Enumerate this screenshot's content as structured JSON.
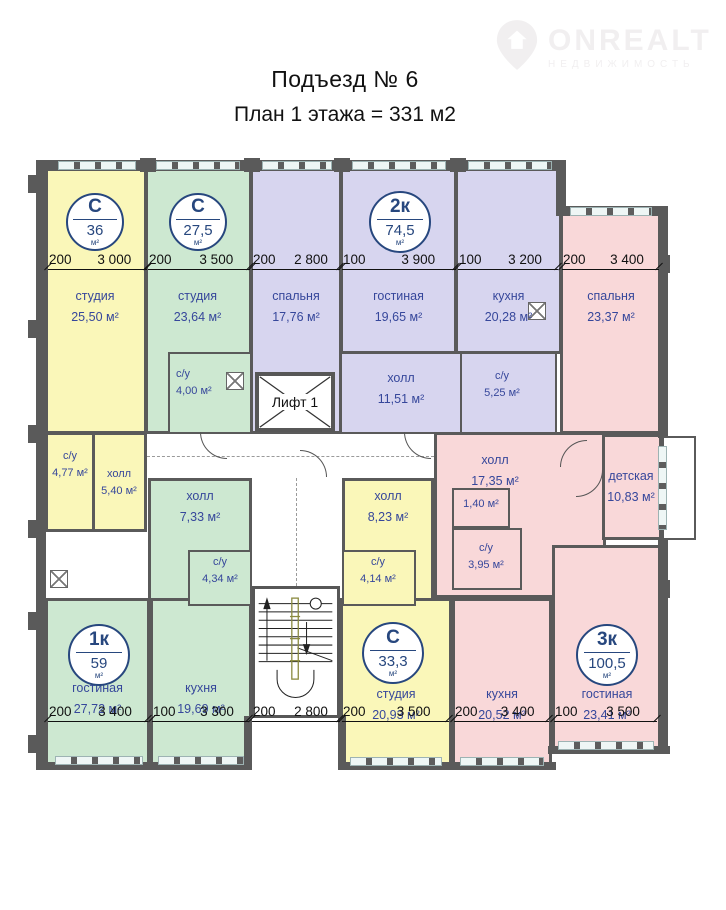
{
  "header": {
    "title": "Подъезд  № 6",
    "subtitle": "План 1 этажа = 331 м2"
  },
  "logo": {
    "brand": "ONREALT",
    "tagline": "НЕДВИЖИМОСТЬ"
  },
  "plan": {
    "elevator_label": "Лифт 1",
    "badges": [
      {
        "type": "C",
        "area": "36",
        "unit": "м²"
      },
      {
        "type": "C",
        "area": "27,5",
        "unit": "м²"
      },
      {
        "type": "2к",
        "area": "74,5",
        "unit": "м²"
      },
      {
        "type": "1к",
        "area": "59",
        "unit": "м²"
      },
      {
        "type": "C",
        "area": "33,3",
        "unit": "м²"
      },
      {
        "type": "3к",
        "area": "100,5",
        "unit": "м²"
      }
    ],
    "rooms": [
      {
        "name": "студия",
        "area": "25,50 м²"
      },
      {
        "name": "студия",
        "area": "23,64 м²"
      },
      {
        "name": "с/у",
        "area": "4,00 м²"
      },
      {
        "name": "спальня",
        "area": "17,76 м²"
      },
      {
        "name": "гостиная",
        "area": "19,65 м²"
      },
      {
        "name": "кухня",
        "area": "20,28 м²"
      },
      {
        "name": "холл",
        "area": "11,51 м²"
      },
      {
        "name": "с/у",
        "area": "5,25 м²"
      },
      {
        "name": "спальня",
        "area": "23,37 м²"
      },
      {
        "name": "с/у",
        "area": "4,77 м²"
      },
      {
        "name": "холл",
        "area": "5,40 м²"
      },
      {
        "name": "холл",
        "area": "7,33 м²"
      },
      {
        "name": "с/у",
        "area": "4,34 м²"
      },
      {
        "name": "холл",
        "area": "8,23 м²"
      },
      {
        "name": "с/у",
        "area": "4,14 м²"
      },
      {
        "name": "холл",
        "area": "17,35 м²"
      },
      {
        "name": "детская",
        "area": "10,83 м²"
      },
      {
        "name": "",
        "area": "1,40 м²"
      },
      {
        "name": "с/у",
        "area": "3,95 м²"
      },
      {
        "name": "гостиная",
        "area": "27,72 м²"
      },
      {
        "name": "кухня",
        "area": "19,69 м²"
      },
      {
        "name": "студия",
        "area": "20,93 м²"
      },
      {
        "name": "кухня",
        "area": "20,52 м²"
      },
      {
        "name": "гостиная",
        "area": "23,41 м²"
      }
    ],
    "dims": [
      {
        "offset": "200",
        "length": "3 000"
      },
      {
        "offset": "200",
        "length": "3 500"
      },
      {
        "offset": "200",
        "length": "2 800"
      },
      {
        "offset": "100",
        "length": "3 900"
      },
      {
        "offset": "100",
        "length": "3 200"
      },
      {
        "offset": "200",
        "length": "3 400"
      },
      {
        "offset": "200",
        "length": "3 400"
      },
      {
        "offset": "100",
        "length": "3 300"
      },
      {
        "offset": "200",
        "length": "2 800"
      },
      {
        "offset": "200",
        "length": "3 500"
      },
      {
        "offset": "200",
        "length": "3 400"
      },
      {
        "offset": "100",
        "length": "3 500"
      }
    ],
    "colors": {
      "studio_yellow": "#faf7b9",
      "green": "#cde8d1",
      "purple": "#d7d5ef",
      "pink": "#f9d8d9",
      "wall": "#5a5a5a",
      "room_label": "#36479b",
      "badge_navy": "#27477e"
    }
  }
}
